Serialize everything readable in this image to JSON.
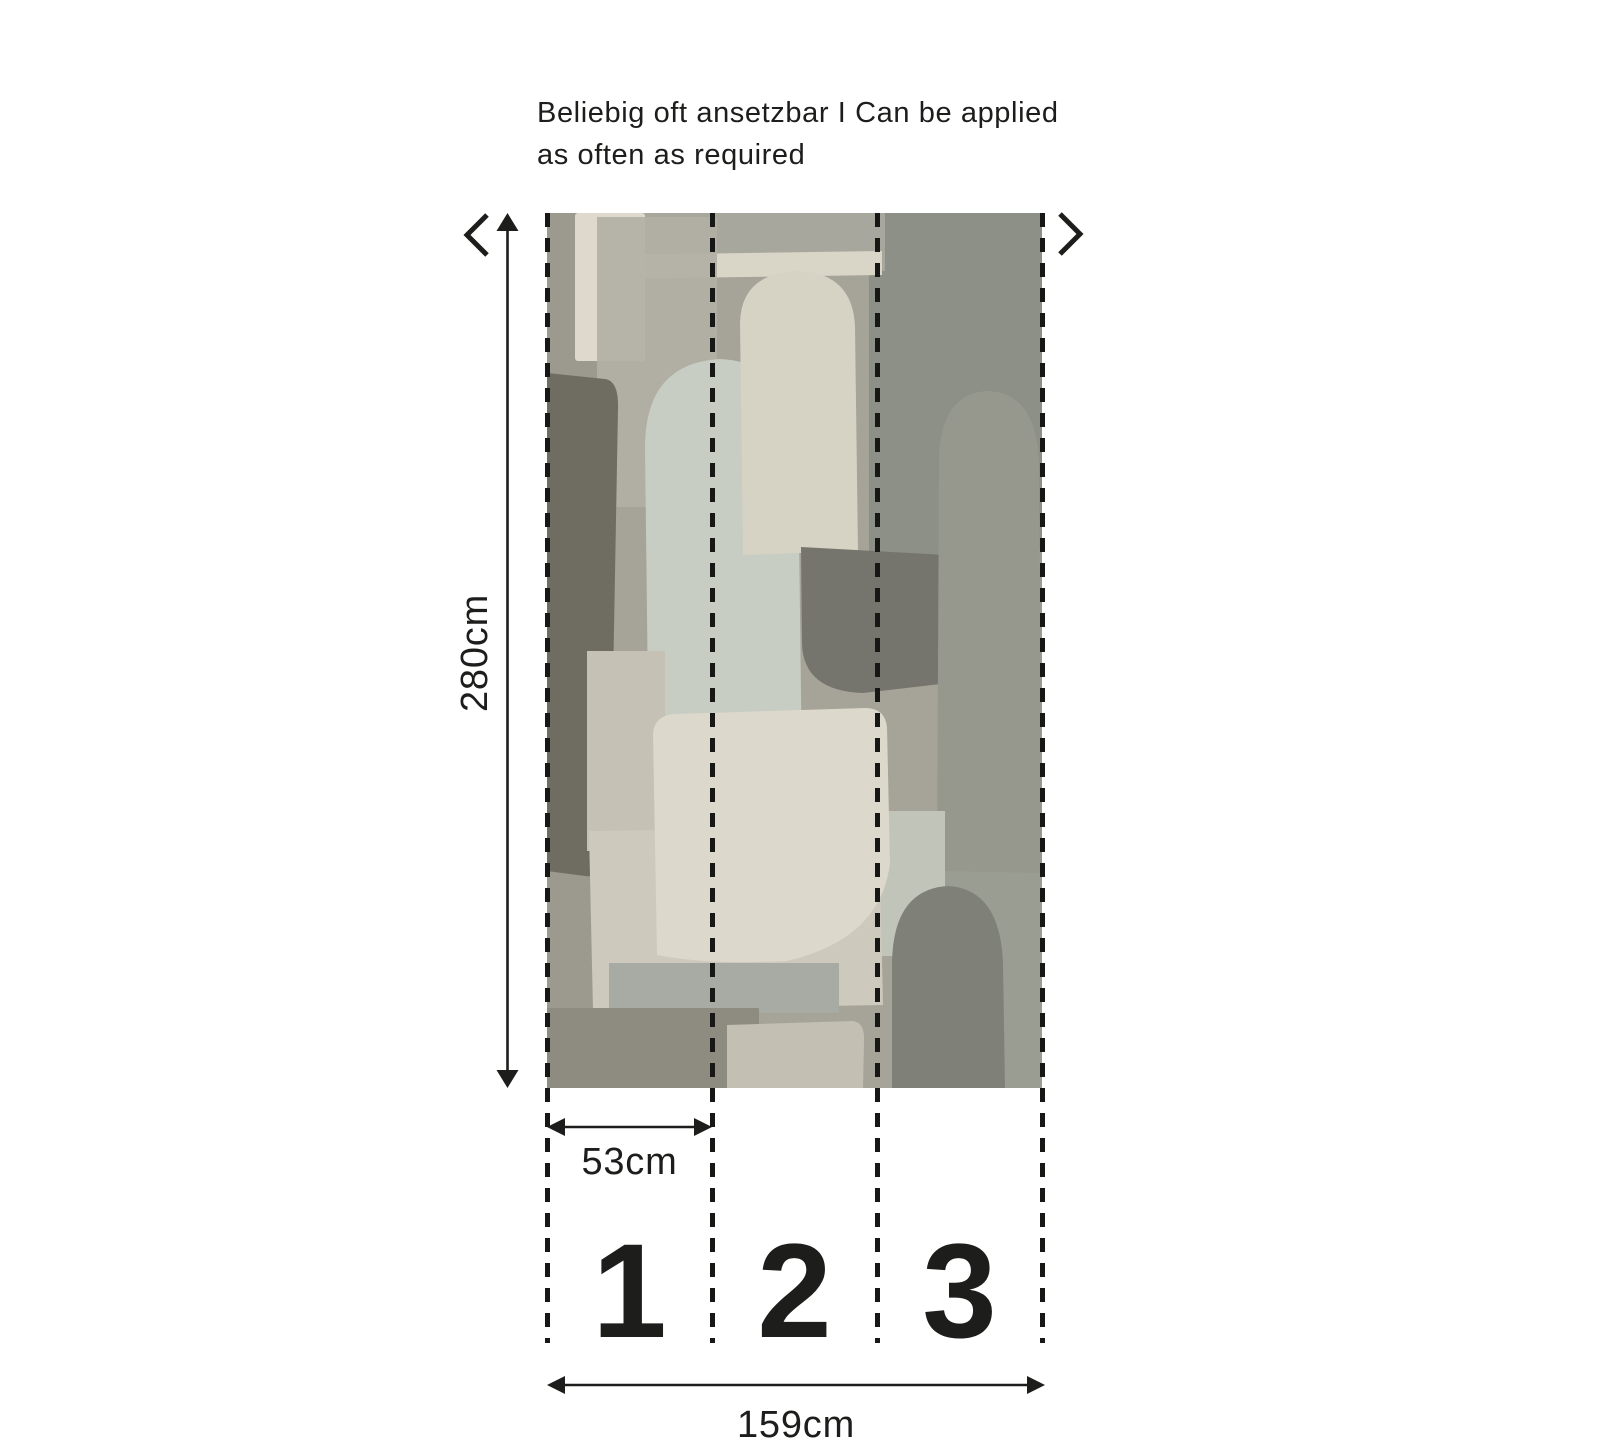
{
  "note": {
    "line1": "Beliebig oft ansetzbar I Can be applied",
    "line2": "as often as required"
  },
  "dimensions": {
    "height": "280cm",
    "strip_width": "53cm",
    "total_width": "159cm"
  },
  "strips": [
    {
      "number": "1"
    },
    {
      "number": "2"
    },
    {
      "number": "3"
    }
  ],
  "icons": {
    "chevron_left": "repeat-pattern-left",
    "chevron_right": "repeat-pattern-right",
    "height_arrow": "double-headed-vertical-arrow",
    "strip_width_arrow": "double-headed-horizontal-arrow",
    "total_width_arrow": "double-headed-horizontal-arrow"
  },
  "palette": {
    "ink": "#1d1d1b",
    "background": "#ffffff",
    "wallpaper_base": "#a6a398",
    "wallpaper_cream": "#dcd8cb",
    "wallpaper_beige": "#cdc9bc",
    "wallpaper_sage": "#c7cdc2",
    "wallpaper_slate": "#75756d",
    "wallpaper_dark_taupe": "#6f6c62",
    "wallpaper_dark_green_grey": "#8d9086"
  }
}
